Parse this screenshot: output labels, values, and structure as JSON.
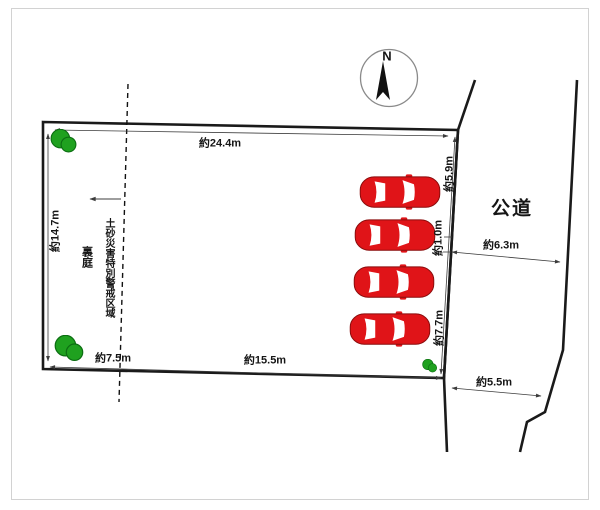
{
  "compass": {
    "north_label": "N"
  },
  "lot": {
    "top_width": "約24.4m",
    "left_height": "約14.7m",
    "bottom_left_width": "約7.5m",
    "bottom_width": "約15.5m",
    "right_upper": "約5.9m",
    "right_middle": "約1.0m",
    "right_lower": "約7.7m",
    "backyard_label": "裏庭",
    "hazard_area_label": "土砂災害特別警戒区域"
  },
  "road": {
    "label": "公道",
    "width_upper": "約6.3m",
    "width_lower": "約5.5m"
  },
  "objects": {
    "car_count": 4,
    "tree_count": 3
  },
  "colors": {
    "car_red": "#e01418",
    "tree_green": "#1fa11f",
    "tree_green_dark": "#0c6e12",
    "line_black": "#1a1a1a",
    "measure_gray": "#3c3c3c"
  }
}
